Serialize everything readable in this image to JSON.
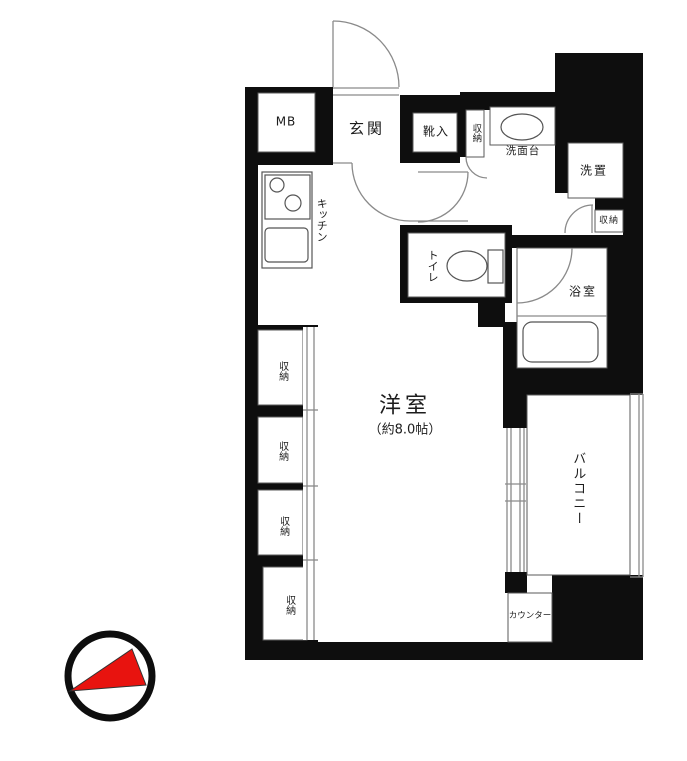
{
  "floorplan": {
    "labels": {
      "mb": "MB",
      "genkan": "玄関",
      "shoe_box": "靴入",
      "storage_entrance": "収納",
      "washstand": "洗面台",
      "laundry": "洗置",
      "storage_right": "収納",
      "kitchen": "キッチン",
      "toilet": "トイレ",
      "bathroom": "浴室",
      "main_room": "洋室",
      "main_room_size": "（約8.0帖）",
      "balcony": "バルコニー",
      "closet1": "収納",
      "closet2": "収納",
      "closet3": "収納",
      "closet4": "収納",
      "counter": "カウンター"
    },
    "colors": {
      "wall": "#0e0e0e",
      "line_gray": "#8a8a8a",
      "fixture_gray": "#555555",
      "compass_red": "#e8130f"
    }
  }
}
